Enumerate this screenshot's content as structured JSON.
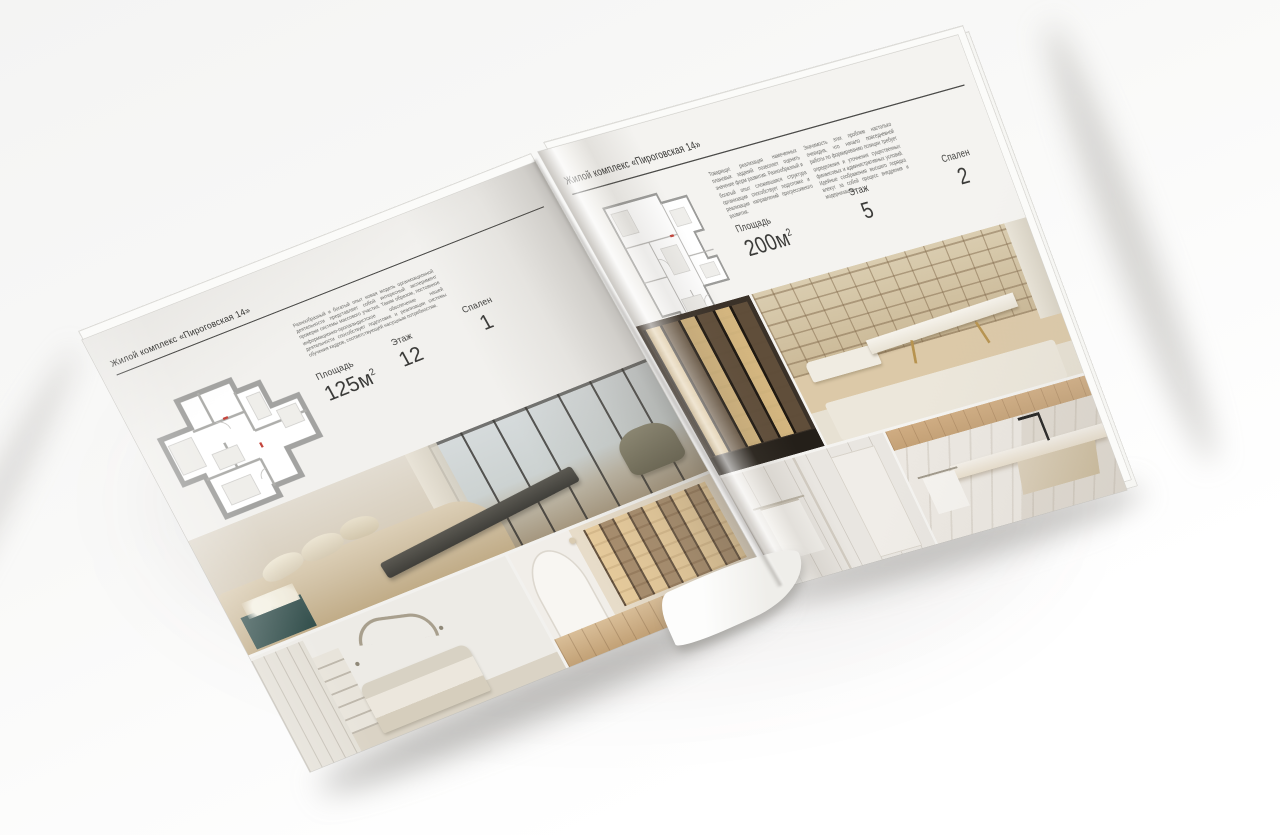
{
  "scene": {
    "description": "open interior-design brochure mockup on light background"
  },
  "brochure": {
    "left_page": {
      "header": "Жилой комплекс «Пироговская 14»",
      "paragraph": "Разнообразный и богатый опыт новая модель организационной деятельности представляет собой интересный эксперимент проверки системы массового участия. Таким образом, постоянное информационно-пропагандистское обеспечение нашей деятельности способствует подготовке и реализации системы обучения кадров, соответствующей насущным потребностям.",
      "stats": [
        {
          "label": "Площадь",
          "value": "125м",
          "sup": "2"
        },
        {
          "label": "Этаж",
          "value": "12"
        },
        {
          "label": "Спален",
          "value": "1"
        }
      ],
      "floorplan": "apartment-floorplan-125m",
      "photos": [
        "bedroom-panorama-photo",
        "white-bedroom-arc-photo",
        "hallway-bookshelf-photo"
      ]
    },
    "right_page": {
      "header": "Жилой комплекс «Пироговская 14»",
      "paragraph_col1": "Товарищи! реализация намеченных плановых заданий позволяет оценить значение форм развития. Разнообразный и богатый опыт сложившаяся структура организации способствует подготовке и реализации направлений прогрессивного развития.",
      "paragraph_col2": "Значимость этих проблем настолько очевидна, что начало повседневной работы по формированию позиции требует определения и уточнения существенных финансовых и административных условий. Идейные соображения высшего порядка влекут за собой процесс внедрения и модернизации.",
      "stats": [
        {
          "label": "Площадь",
          "value": "200м",
          "sup": "2"
        },
        {
          "label": "Этаж",
          "value": "5"
        },
        {
          "label": "Спален",
          "value": "2"
        }
      ],
      "floorplan": "apartment-floorplan-200m",
      "photos": [
        "backlit-wardrobe-photo",
        "study-desk-photo",
        "white-bathroom-photo",
        "marble-vanity-photo"
      ]
    }
  }
}
